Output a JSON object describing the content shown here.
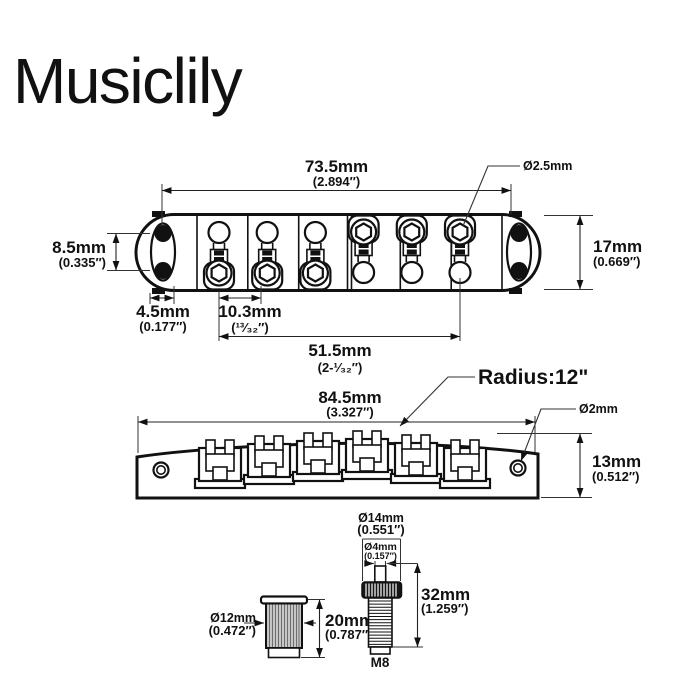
{
  "brand": {
    "logo": "Musiclily"
  },
  "top_view": {
    "overall_width": {
      "label": "73.5mm",
      "inches": "(2.894″)"
    },
    "screw_dia": {
      "label": "Ø2.5mm"
    },
    "slot_spacing": {
      "label": "8.5mm",
      "inches": "(0.335″)"
    },
    "body_width": {
      "label": "17mm",
      "inches": "(0.669″)"
    },
    "edge_offset": {
      "label": "4.5mm",
      "inches": "(0.177″)"
    },
    "string_spacing": {
      "label": "10.3mm",
      "inches": "(¹³⁄₃₂″)"
    },
    "string_span": {
      "label": "51.5mm",
      "inches": "(2-¹⁄₃₂″)"
    }
  },
  "side_view": {
    "radius": {
      "label": "Radius:12\""
    },
    "overall_length": {
      "label": "84.5mm",
      "inches": "(3.327″)"
    },
    "hole_dia": {
      "label": "Ø2mm"
    },
    "body_height": {
      "label": "13mm",
      "inches": "(0.512″)"
    }
  },
  "bushing": {
    "dia": {
      "label": "Ø12mm",
      "inches": "(0.472″)"
    },
    "height": {
      "label": "20mm",
      "inches": "(0.787″)"
    }
  },
  "post": {
    "head_dia": {
      "label": "Ø14mm",
      "inches": "(0.551″)"
    },
    "tip_dia": {
      "label": "Ø4mm",
      "inches": "(0.157″)"
    },
    "length": {
      "label": "32mm",
      "inches": "(1.259″)"
    },
    "thread": {
      "label": "M8"
    }
  }
}
